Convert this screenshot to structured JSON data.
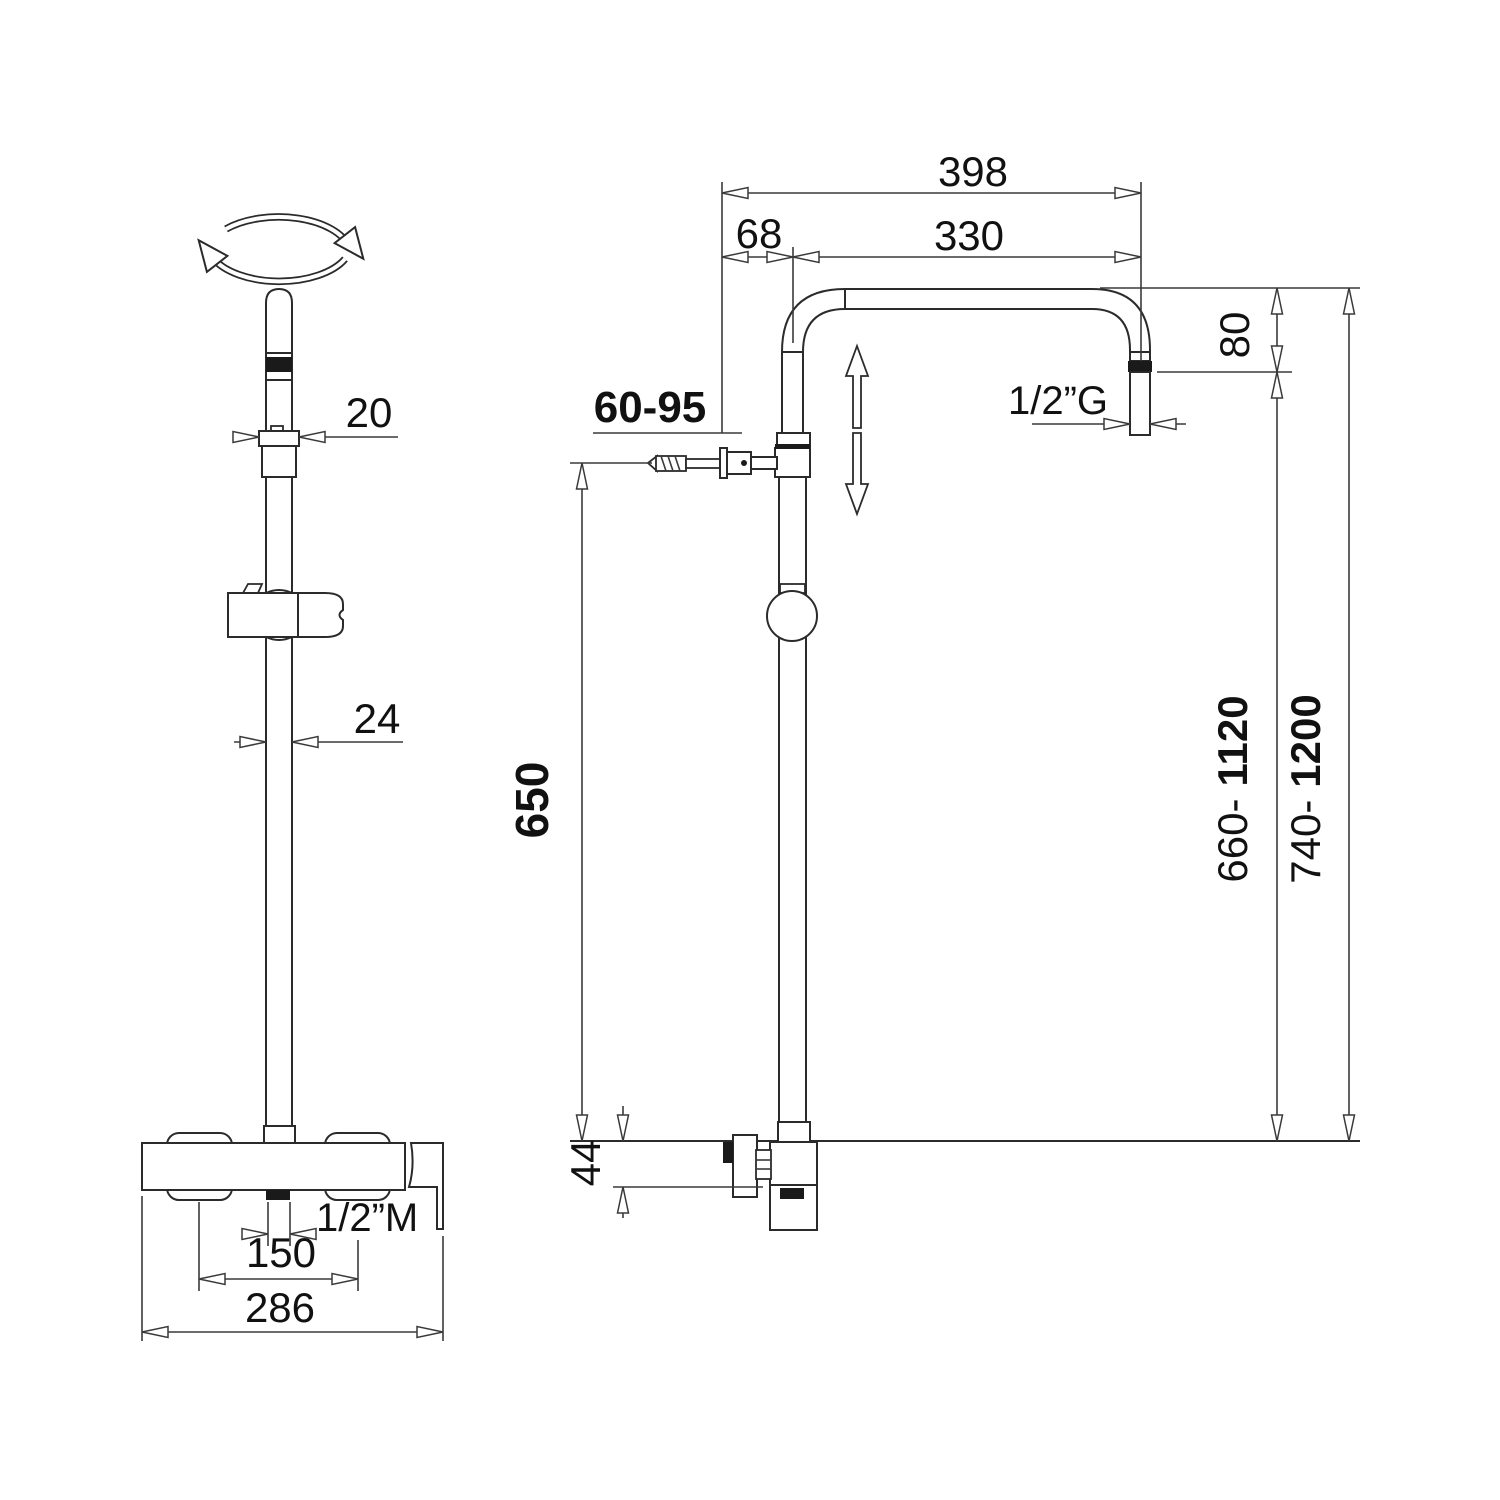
{
  "palette": {
    "ink": "#2b2b2b",
    "paper": "#ffffff"
  },
  "front_view": {
    "dim_top_diameter": "20",
    "dim_riser_diameter": "24",
    "dim_inlet_thread": "1/2”M",
    "dim_inlet_spacing": "150",
    "dim_body_width": "286"
  },
  "side_view": {
    "dim_arm_overall": "398",
    "dim_wall_offset": "68",
    "dim_arm_span": "330",
    "dim_head_drop": "80",
    "dim_outlet_thread": "1/2”G",
    "dim_wall_clearance": "60-95",
    "dim_bracket_height": "650",
    "dim_valve_drop": "44",
    "dim_outlet_height_min": "660-",
    "dim_outlet_height_max": "1120",
    "dim_total_height_min": "740-",
    "dim_total_height_max": "1200"
  }
}
